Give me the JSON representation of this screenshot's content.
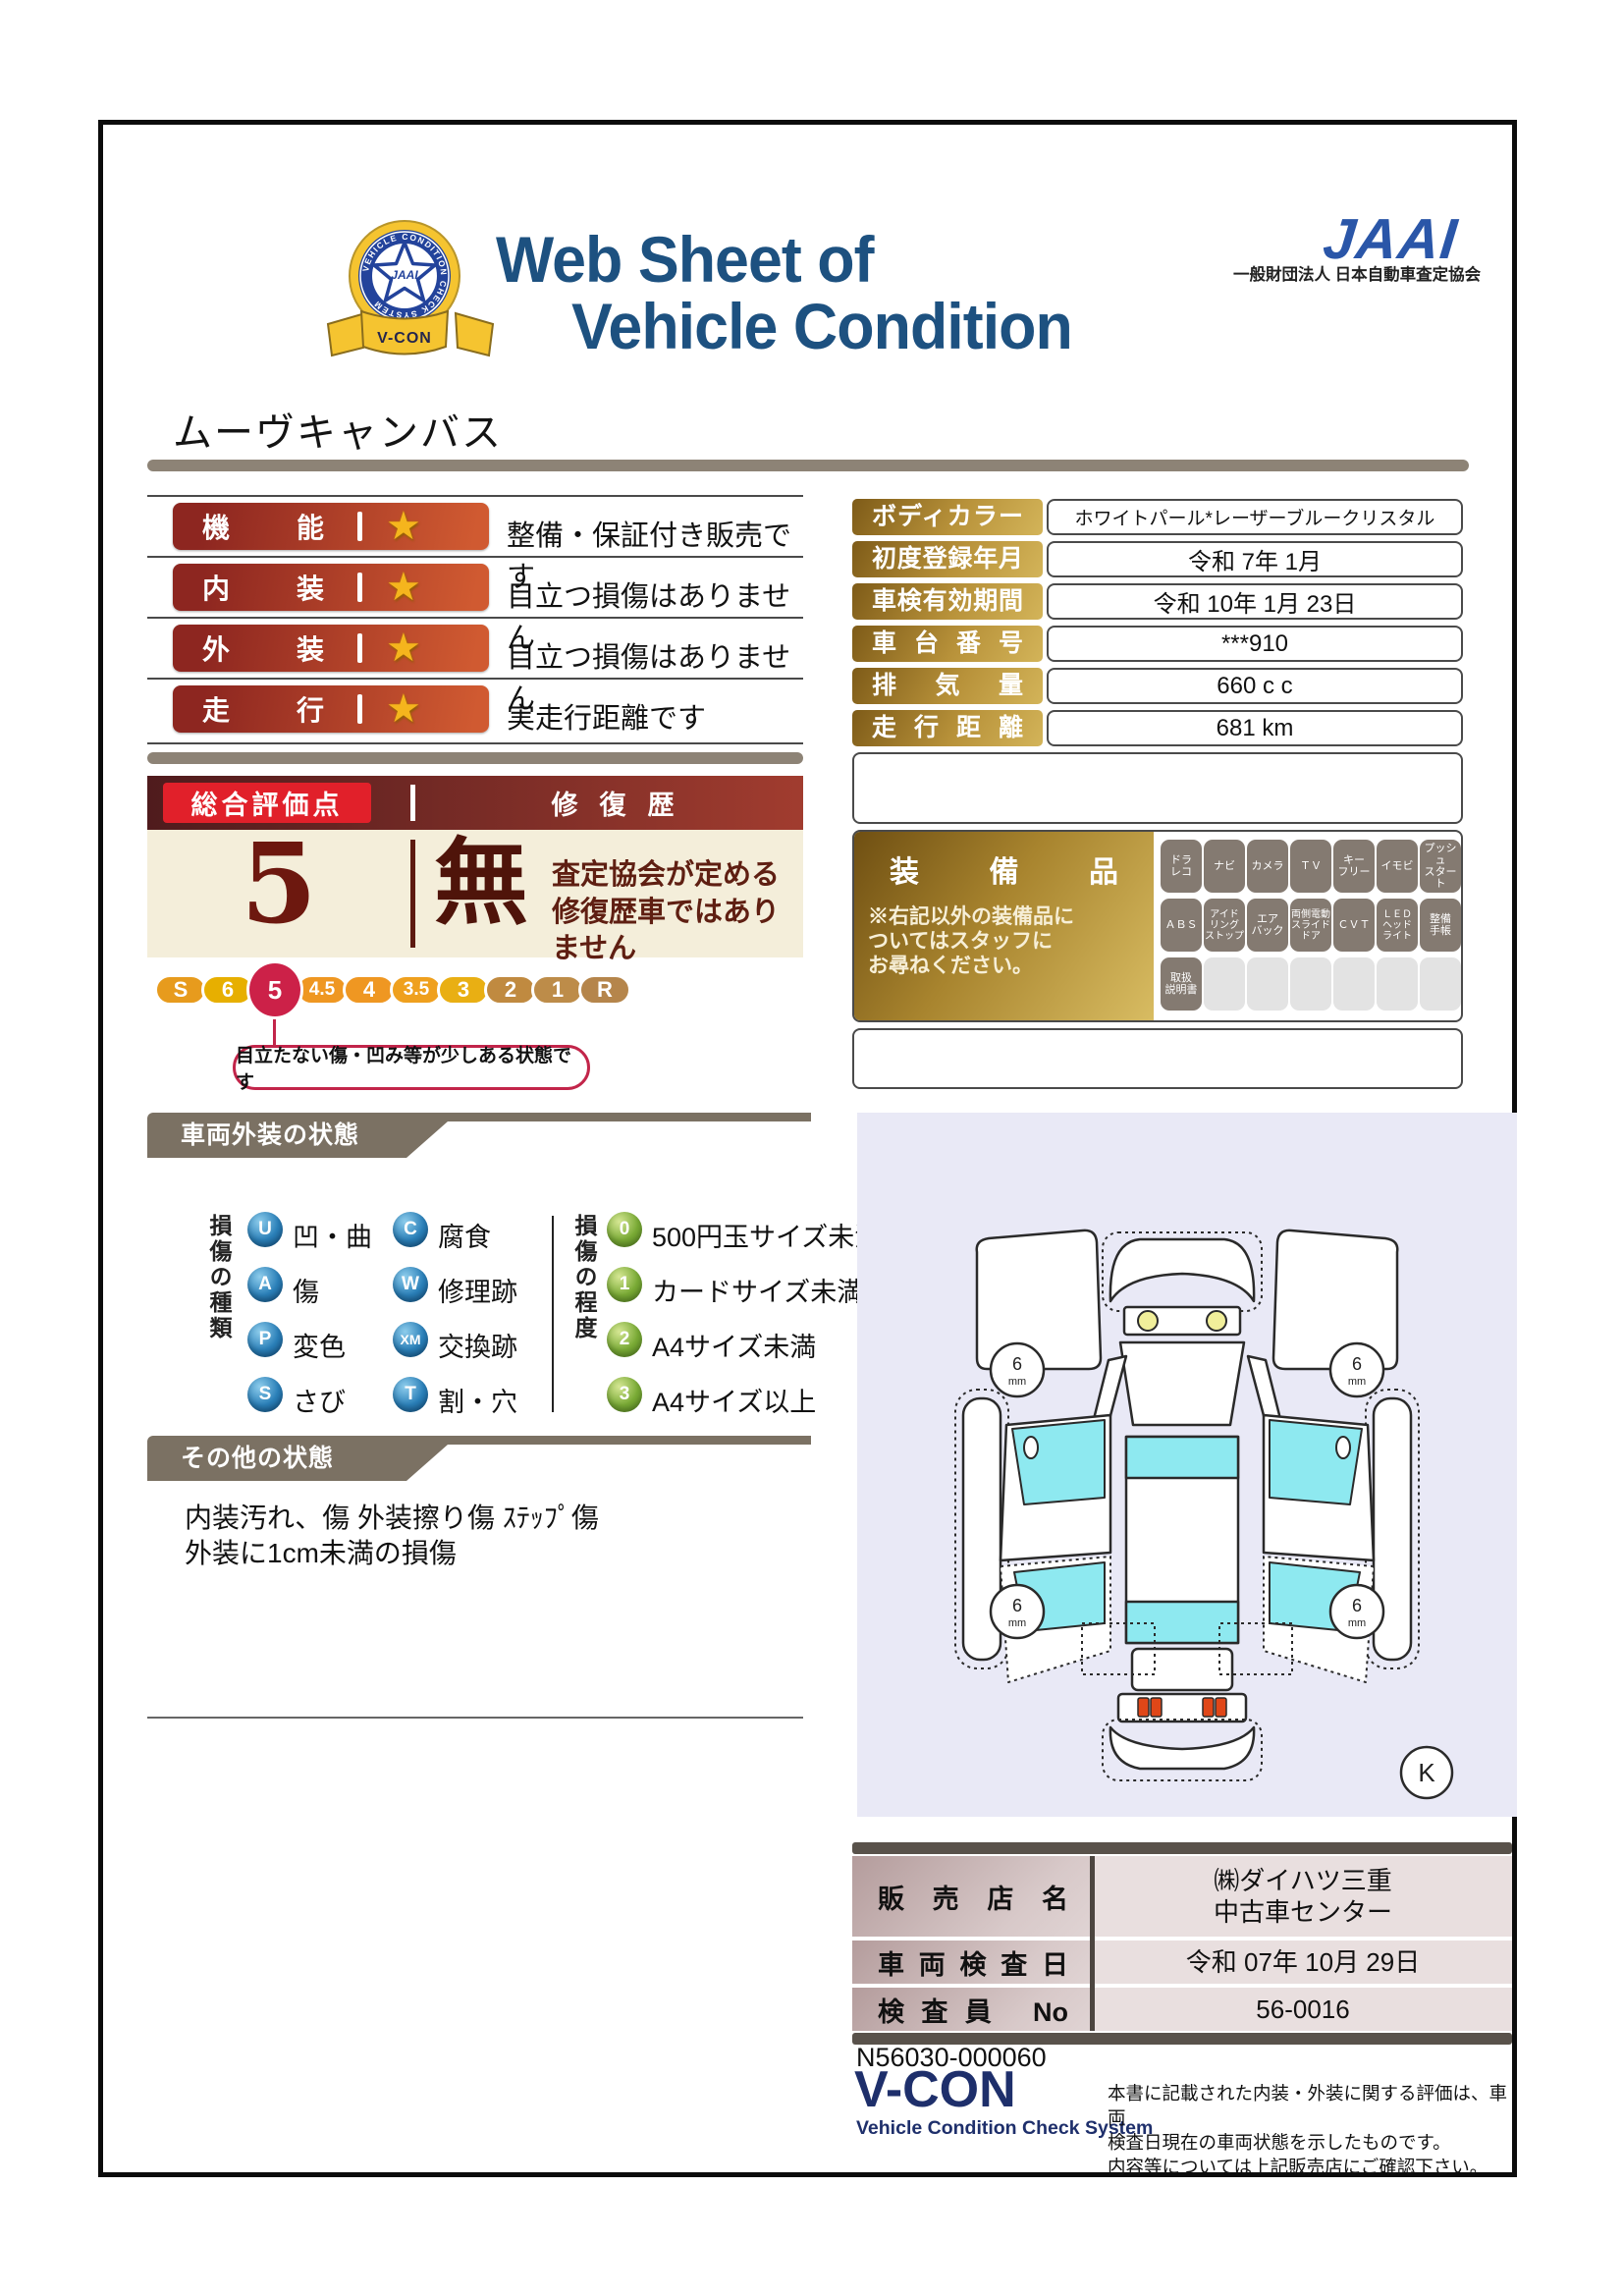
{
  "header": {
    "badge": {
      "ring_text": "VEHICLE CONDITION CHECK SYSTEM",
      "star_text": "JAAI",
      "ribbon": "V-CON"
    },
    "title_line1": "Web Sheet of",
    "title_line2": "Vehicle Condition",
    "logo_text": "JAAI",
    "org_name": "一般財団法人 日本自動車査定協会"
  },
  "vehicle_name": "ムーヴキャンバス",
  "ratings": [
    {
      "label": "機能",
      "desc": "整備・保証付き販売です"
    },
    {
      "label": "内装",
      "desc": "目立つ損傷はありません"
    },
    {
      "label": "外装",
      "desc": "目立つ損傷はありません"
    },
    {
      "label": "走行",
      "desc": "実走行距離です"
    }
  ],
  "info_table": [
    {
      "label": "ボディカラー",
      "value": "ホワイトパール*レーザーブルークリスタル"
    },
    {
      "label": "初度登録年月",
      "value": "令和 7年 1月"
    },
    {
      "label": "車検有効期間",
      "value": "令和 10年 1月 23日"
    },
    {
      "label": "車台番号",
      "value": "***910"
    },
    {
      "label": "排気量",
      "value": "660 c c"
    },
    {
      "label": "走行距離",
      "value": "681 km"
    }
  ],
  "overall": {
    "header_left": "総合評価点",
    "header_right": "修復歴",
    "score": "5",
    "repair_flag": "無",
    "repair_desc_line1": "査定協会が定める",
    "repair_desc_line2": "修復歴車ではありません",
    "scale": [
      "S",
      "6",
      "5",
      "4.5",
      "4",
      "3.5",
      "3",
      "2",
      "1",
      "R"
    ],
    "selected_grade": "5",
    "callout": "目立たない傷・凹み等が少しある状態です"
  },
  "equipment": {
    "title": "装備品",
    "note": "※右記以外の装備品に\nついてはスタッフに\nお尋ねください。",
    "row1": [
      "ドラ\nレコ",
      "ナビ",
      "カメラ",
      "ＴＶ",
      "キー\nフリー",
      "イモビ",
      "プッシュ\nスタート"
    ],
    "row2": [
      "ＡＢＳ",
      "アイド\nリング\nストップ",
      "エア\nバック",
      "両側電動\nスライド\nドア",
      "ＣＶＴ",
      "ＬＥＤ\nヘッド\nライト",
      "整備\n手帳"
    ],
    "row3": [
      "取扱\n説明書"
    ]
  },
  "exterior": {
    "section_title": "車両外装の状態",
    "type_header": "損傷の種類",
    "types": [
      {
        "code": "U",
        "label": "凹・曲"
      },
      {
        "code": "A",
        "label": "傷"
      },
      {
        "code": "P",
        "label": "変色"
      },
      {
        "code": "S",
        "label": "さび"
      },
      {
        "code": "C",
        "label": "腐食"
      },
      {
        "code": "W",
        "label": "修理跡"
      },
      {
        "code": "XM",
        "label": "交換跡"
      },
      {
        "code": "T",
        "label": "割・穴"
      }
    ],
    "degree_header": "損傷の程度",
    "degrees": [
      {
        "code": "0",
        "label": "500円玉サイズ未満"
      },
      {
        "code": "1",
        "label": "カードサイズ未満"
      },
      {
        "code": "2",
        "label": "A4サイズ未満"
      },
      {
        "code": "3",
        "label": "A4サイズ以上"
      }
    ]
  },
  "other_condition": {
    "section_title": "その他の状態",
    "line1": "内装汚れ、傷 外装擦り傷 ｽﾃｯﾌﾟ傷",
    "line2": "外装に1cm未満の損傷"
  },
  "diagram": {
    "tread_value": "6",
    "tread_unit": "mm",
    "marker": "K"
  },
  "dealer": [
    {
      "label": "販売店名",
      "value": "㈱ダイハツ三重\n中古車センター"
    },
    {
      "label": "車両検査日",
      "value": "令和 07年 10月 29日"
    },
    {
      "label": "検査員 No",
      "value": "56-0016"
    }
  ],
  "footer": {
    "serial": "N56030-000060",
    "vcon": "V-CON",
    "vcon_sub": "Vehicle Condition Check System",
    "note_line1": "本書に記載された内装・外装に関する評価は、車両",
    "note_line2": "検査日現在の車両状態を示したものです。",
    "note_line3": "内容等については上記販売店にご確認下さい。"
  },
  "colors": {
    "title_blue": "#1d5180",
    "jaai_blue": "#2a56a8",
    "rating_bar_start": "#8d2620",
    "rating_bar_end": "#d05a31",
    "star_gold": "#f5b51d",
    "gold_label_dark": "#7e5b18",
    "gold_label_light": "#d3b459",
    "overall_cream": "#f4eeda",
    "overall_maroon": "#5d1a10",
    "selected_grade_red": "#cc2148",
    "scale_colors": [
      "#e79b1d",
      "#e7af00",
      "#cc2148",
      "#ef9722",
      "#ef9722",
      "#efa01e",
      "#e9af13",
      "#c08a40",
      "#bd8c49",
      "#b5854b"
    ],
    "badge_active": "#847a71",
    "badge_inactive": "#e3e3e3",
    "tab_gray": "#7b7163",
    "type_icon_blue": "#2a7fb8",
    "degree_icon_green": "#79aa35",
    "panel_lavender": "#e9e9f6",
    "window_cyan": "#8ee9f0",
    "dealer_label_mauve": "#c9b4b4",
    "dealer_value_pink": "#e9dfdf",
    "vcon_navy": "#1e2f6b"
  }
}
